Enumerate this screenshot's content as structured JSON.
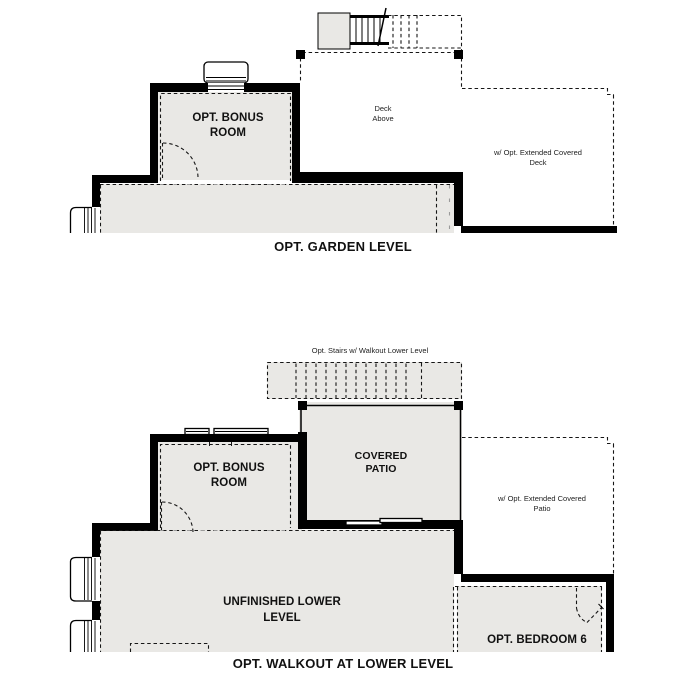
{
  "colors": {
    "background": "#ffffff",
    "room_fill": "#e9e8e5",
    "wall_color": "#000000",
    "line_color": "#161616"
  },
  "plans": {
    "garden": {
      "title": "OPT. GARDEN LEVEL",
      "rooms": {
        "bonus": "OPT. BONUS ROOM",
        "deck": "Deck Above",
        "extended_deck": "w/ Opt. Extended Covered Deck"
      }
    },
    "walkout": {
      "title": "OPT. WALKOUT AT LOWER LEVEL",
      "stairs_note": "Opt. Stairs w/ Walkout Lower Level",
      "rooms": {
        "bonus": "OPT. BONUS ROOM",
        "covered_patio": "COVERED PATIO",
        "extended_patio": "w/ Opt. Extended Covered Patio",
        "unfinished": "UNFINISHED LOWER LEVEL",
        "bedroom6": "OPT. BEDROOM 6"
      }
    }
  }
}
